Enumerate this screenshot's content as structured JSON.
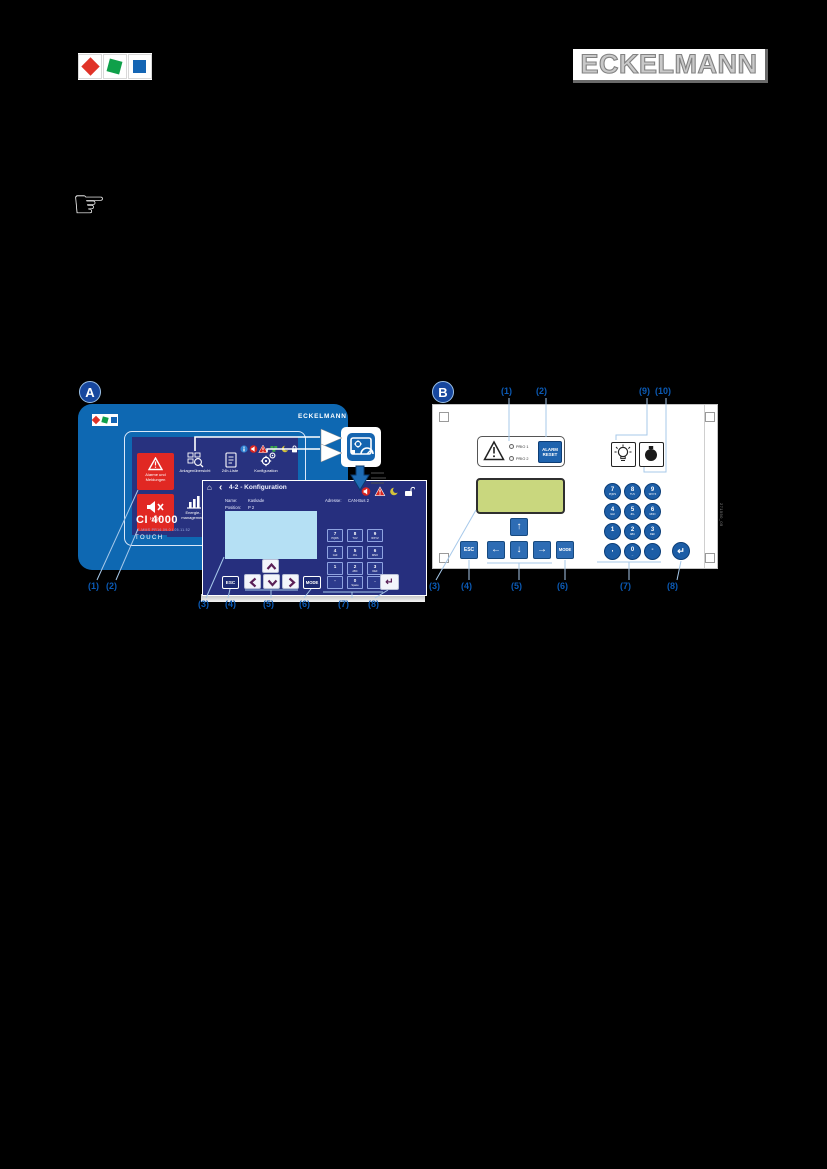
{
  "header": {
    "wordmark": "ECKELMANN",
    "hand_glyph": "☞"
  },
  "colors": {
    "device_blue": "#0e68b2",
    "screen_navy": "#262f7e",
    "tile_red": "#e12823",
    "callout_blue": "#0b5ab5",
    "callout_line": "#a7c9ea",
    "lcd_green": "#c9d77e",
    "key_blue": "#1c5da6",
    "nav_blue": "#2d6cb4",
    "display_lightblue": "#b5e0f4",
    "logo_red": "#e03227",
    "logo_green": "#0fa04a",
    "logo_blue": "#1465b4"
  },
  "figure_a": {
    "badge": "A",
    "device": {
      "brand": "ECKELMANN",
      "panel_label": "TOUCH",
      "model": "CI 4000",
      "model_sub": "C-MMS PR16.09.0 L05.11.52",
      "tile_alarm_1": "Alarme und",
      "tile_alarm_2": "Meldungen",
      "tile_overview": "Anlagenübersicht",
      "tile_24h": "24h-Liste",
      "tile_config": "Konfiguration",
      "tile_horn": "Hupe",
      "tile_energy_1": "Energie-",
      "tile_energy_2": "management"
    },
    "dialog": {
      "home_glyph": "⌂",
      "back_glyph": "‹",
      "title": "4-2 - Konfiguration",
      "name_label": "Name:",
      "name_value": "Kaskade",
      "position_label": "Position:",
      "position_value": "P 2",
      "address_label": "Adresse:",
      "address_value": "CAN-Bus 2",
      "esc": "ESC",
      "mode": "MODE",
      "enter_glyph": "↵",
      "keys": [
        {
          "d": "7",
          "l": "PQRS"
        },
        {
          "d": "8",
          "l": "TUV"
        },
        {
          "d": "9",
          "l": "WXYZ"
        },
        {
          "d": "4",
          "l": "GHI"
        },
        {
          "d": "5",
          "l": "JKL"
        },
        {
          "d": "6",
          "l": "MNO"
        },
        {
          "d": "1",
          "l": ""
        },
        {
          "d": "2",
          "l": "ABC"
        },
        {
          "d": "3",
          "l": "DEF"
        },
        {
          "d": "-",
          "l": ""
        },
        {
          "d": "0",
          "l": "Space"
        },
        {
          "d": ".",
          "l": ""
        }
      ]
    },
    "callouts": [
      "(1)",
      "(2)",
      "(3)",
      "(4)",
      "(5)",
      "(6)",
      "(7)",
      "(8)"
    ]
  },
  "figure_b": {
    "badge": "B",
    "led1": "PRIO 1",
    "led2": "PRIO 2",
    "alarm_reset_1": "ALARM",
    "alarm_reset_2": "RESET",
    "esc": "ESC",
    "mode": "MODE",
    "enter_glyph": "↵",
    "arrows": {
      "up": "↑",
      "left": "←",
      "down": "↓",
      "right": "→"
    },
    "keys": [
      {
        "d": "7",
        "l": "PQRS"
      },
      {
        "d": "8",
        "l": "TUV"
      },
      {
        "d": "9",
        "l": "WXYZ"
      },
      {
        "d": "4",
        "l": "GHI"
      },
      {
        "d": "5",
        "l": "JKL"
      },
      {
        "d": "6",
        "l": "MNO"
      },
      {
        "d": "1",
        "l": ""
      },
      {
        "d": "2",
        "l": "ABC"
      },
      {
        "d": "3",
        "l": "DEF"
      },
      {
        "d": ",",
        "l": ""
      },
      {
        "d": "0",
        "l": "_"
      },
      {
        "d": "-",
        "l": ""
      }
    ],
    "side_code": "271550_05",
    "callouts_top": [
      "(1)",
      "(2)",
      "(9)",
      "(10)"
    ],
    "callouts_bottom": [
      "(3)",
      "(4)",
      "(5)",
      "(6)",
      "(7)",
      "(8)"
    ]
  }
}
